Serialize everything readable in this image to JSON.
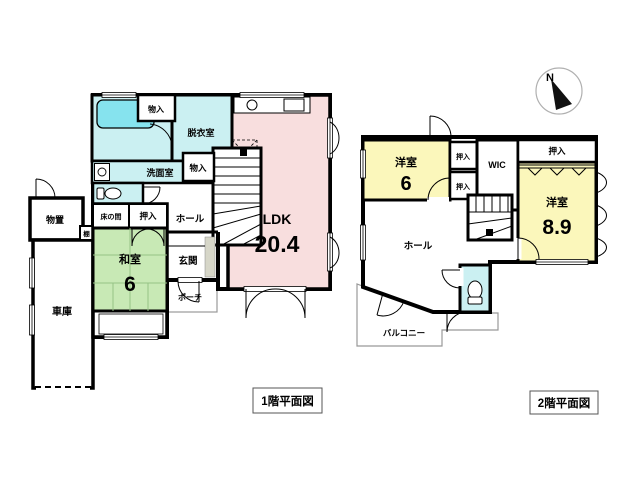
{
  "page": {
    "background": "#ffffff"
  },
  "colors": {
    "wall": "#000000",
    "ldk_pink": "#f8dede",
    "tatami_green": "#c8e9b5",
    "tatami_line": "#96c285",
    "room_yellow": "#fbf7bb",
    "wet_cyan": "#cbf0f2",
    "tub_cyan": "#86e3ee",
    "outline_gray": "#999999",
    "genkan_gray": "#d6d6c8"
  },
  "compass": {
    "north_label": "N"
  },
  "floor1": {
    "title": "1階平面図",
    "rooms": {
      "ldk": {
        "name": "LDK",
        "area": "20.4"
      },
      "washitsu": {
        "name": "和室",
        "area": "6"
      },
      "genkan": {
        "name": "玄関"
      },
      "porch": {
        "name": "ポーチ"
      },
      "hall": {
        "name": "ホール"
      },
      "senmenshitsu": {
        "name": "洗面室"
      },
      "datsuishitsu": {
        "name": "脱衣室"
      },
      "monoire_top": {
        "name": "物入"
      },
      "monoire_stairs": {
        "name": "物入"
      },
      "oshiire": {
        "name": "押入"
      },
      "tokonoma": {
        "name": "床の間"
      },
      "monooki": {
        "name": "物置"
      },
      "tana": {
        "name": "棚"
      },
      "garage": {
        "name": "車庫"
      }
    }
  },
  "floor2": {
    "title": "2階平面図",
    "rooms": {
      "yoshitsu_6": {
        "name": "洋室",
        "area": "6"
      },
      "yoshitsu_89": {
        "name": "洋室",
        "area": "8.9"
      },
      "oshiire_upper": {
        "name": "押入"
      },
      "oshiire_lower": {
        "name": "押入"
      },
      "oshiire_wide": {
        "name": "押入"
      },
      "wic": {
        "name": "WIC"
      },
      "hall": {
        "name": "ホール"
      },
      "balcony": {
        "name": "バルコニー"
      }
    }
  }
}
